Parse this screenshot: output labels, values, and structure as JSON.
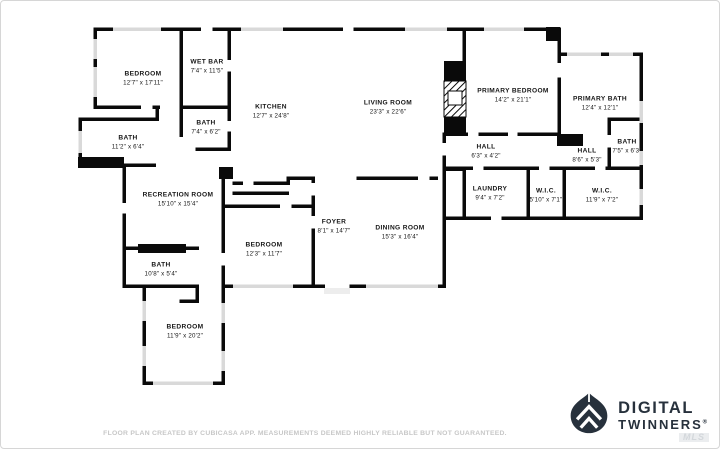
{
  "floorplan": {
    "wall_color": "#0a0a0a",
    "window_color": "#d9d9d9",
    "rooms": [
      {
        "name": "BEDROOM",
        "dims": "12'7\" x 17'11\"",
        "x": 142,
        "y": 78
      },
      {
        "name": "WET BAR",
        "dims": "7'4\" x 11'5\"",
        "x": 206,
        "y": 66
      },
      {
        "name": "BATH",
        "dims": "7'4\" x 6'2\"",
        "x": 205,
        "y": 127
      },
      {
        "name": "KITCHEN",
        "dims": "12'7\" x 24'8\"",
        "x": 270,
        "y": 111
      },
      {
        "name": "BATH",
        "dims": "11'2\" x 6'4\"",
        "x": 127,
        "y": 142
      },
      {
        "name": "LIVING ROOM",
        "dims": "23'3\" x 22'6\"",
        "x": 387,
        "y": 107
      },
      {
        "name": "PRIMARY BEDROOM",
        "dims": "14'2\" x 21'1\"",
        "x": 512,
        "y": 95
      },
      {
        "name": "PRIMARY BATH",
        "dims": "12'4\" x 12'1\"",
        "x": 599,
        "y": 103
      },
      {
        "name": "BATH",
        "dims": "7'5\" x 6'3\"",
        "x": 626,
        "y": 146
      },
      {
        "name": "HALL",
        "dims": "8'6\" x 5'3\"",
        "x": 586,
        "y": 155
      },
      {
        "name": "HALL",
        "dims": "6'3\" x 4'2\"",
        "x": 485,
        "y": 151
      },
      {
        "name": "LAUNDRY",
        "dims": "9'4\" x 7'2\"",
        "x": 489,
        "y": 193
      },
      {
        "name": "W.I.C.",
        "dims": "5'10\" x 7'1\"",
        "x": 545,
        "y": 195
      },
      {
        "name": "W.I.C.",
        "dims": "11'9\" x 7'2\"",
        "x": 601,
        "y": 195
      },
      {
        "name": "RECREATION ROOM",
        "dims": "15'10\" x 15'4\"",
        "x": 177,
        "y": 199
      },
      {
        "name": "FOYER",
        "dims": "8'1\" x 14'7\"",
        "x": 333,
        "y": 226
      },
      {
        "name": "BEDROOM",
        "dims": "12'3\" x 11'7\"",
        "x": 263,
        "y": 249
      },
      {
        "name": "DINING ROOM",
        "dims": "15'3\" x 16'4\"",
        "x": 399,
        "y": 232
      },
      {
        "name": "BATH",
        "dims": "10'8\" x 5'4\"",
        "x": 160,
        "y": 269
      },
      {
        "name": "BEDROOM",
        "dims": "11'9\" x 20'2\"",
        "x": 184,
        "y": 331
      }
    ]
  },
  "footer": {
    "disclaimer": "FLOOR PLAN CREATED BY CUBICASA APP. MEASUREMENTS DEEMED HIGHLY RELIABLE BUT NOT GUARANTEED."
  },
  "logo": {
    "line1": "DIGITAL",
    "line2": "TWINNERS",
    "registered": "®",
    "watermark": "MLS",
    "color": "#27313c"
  }
}
